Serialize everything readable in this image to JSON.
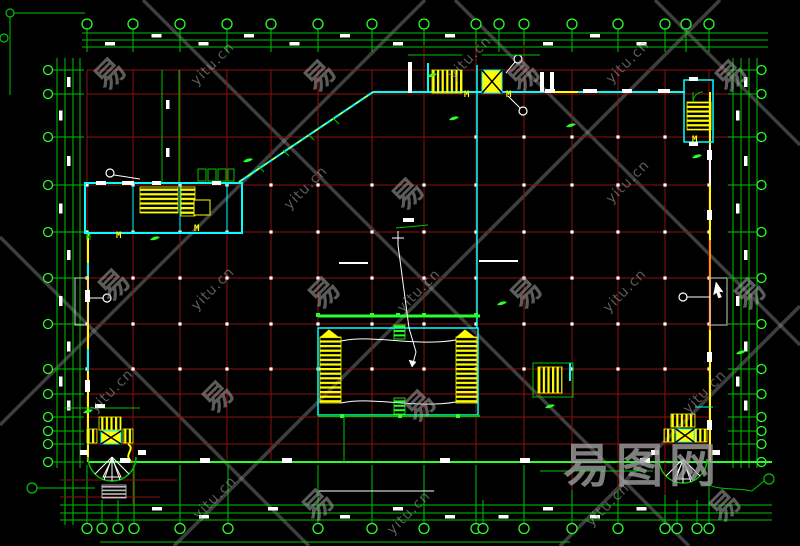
{
  "window": {
    "width": 800,
    "height": 546,
    "background": "#000000",
    "description": "CAD architectural floor plan drawing with column grid, dimension chains, stairs, elevators and corner stair towers"
  },
  "colors": {
    "r": "#8f0f0f",
    "R": "#d40000",
    "g": "#00c400",
    "G": "#2bff2b",
    "c": "#00ffff",
    "y": "#ffff00",
    "w": "#ffffff",
    "o": "#ff9100",
    "d": "#cfcfcf",
    "k": "#000000",
    "wm_line": "#9b9b9b"
  },
  "axes": {
    "vertical_x": [
      87,
      133,
      180,
      227,
      271,
      318,
      372,
      424,
      476,
      524,
      572,
      618,
      665,
      709
    ],
    "horizontal_y": [
      70,
      94,
      137,
      185,
      232,
      278,
      324,
      369,
      394,
      417,
      444
    ],
    "top_bubbles_x": [
      87,
      133,
      180,
      227,
      271,
      318,
      372,
      424,
      476,
      499,
      524,
      572,
      618,
      665,
      686,
      709
    ],
    "bottom_bubbles_x": [
      87,
      102,
      118,
      134,
      180,
      228,
      318,
      372,
      424,
      476,
      483,
      524,
      572,
      618,
      665,
      677,
      697,
      709
    ],
    "left_bubbles_y": [
      70,
      94,
      137,
      185,
      232,
      278,
      324,
      369,
      394,
      417,
      431,
      444,
      462
    ],
    "right_bubbles_y": [
      70,
      94,
      137,
      185,
      232,
      278,
      324,
      369,
      394,
      417,
      431,
      444,
      462
    ],
    "top_band_y": [
      33,
      40,
      47
    ],
    "bottom_band_y": [
      505,
      513,
      520
    ],
    "left_band_x": [
      57,
      65,
      73,
      80
    ],
    "right_band_x": [
      733,
      741,
      749,
      757
    ],
    "top_bubble_row_y": 24,
    "bottom_bubble_row_y": 528.5,
    "left_bubble_col_x": 48,
    "right_bubble_col_x": 761.5
  },
  "grid": {
    "node_rows": [
      185,
      232,
      278,
      324,
      369
    ],
    "node_row_partial": {
      "y": 137,
      "x": [
        476,
        524,
        572,
        618,
        665
      ]
    },
    "green_bottom_line_y": 462
  },
  "features": [
    [
      "ln",
      88,
      232,
      88,
      462,
      "y",
      2
    ],
    [
      "ln",
      88,
      263,
      88,
      276,
      "c",
      2
    ],
    [
      "ln",
      88,
      349,
      88,
      371,
      "c",
      2
    ],
    [
      "ln",
      88,
      428,
      88,
      445,
      "c",
      2
    ],
    [
      "ln",
      710,
      92,
      710,
      462,
      "y",
      2
    ],
    [
      "ln",
      710,
      145,
      710,
      185,
      "w",
      2
    ],
    [
      "ln",
      710,
      240,
      710,
      330,
      "o",
      2
    ],
    [
      "ln",
      373,
      92,
      685,
      92,
      "c",
      2
    ],
    [
      "ln",
      239,
      182,
      373,
      92,
      "c",
      2
    ],
    [
      "ln",
      239,
      182,
      373,
      92,
      "y",
      1,
      "5 5"
    ],
    [
      "ln",
      88,
      462,
      772,
      462,
      "G",
      2
    ],
    [
      "ln",
      319,
      491,
      434,
      491,
      "w",
      1
    ],
    [
      "ln",
      100,
      542,
      570,
      542,
      "g",
      1
    ],
    [
      "ln",
      258,
      166,
      264,
      172,
      "g",
      1
    ],
    [
      "ln",
      283,
      150,
      289,
      156,
      "g",
      1
    ],
    [
      "ln",
      308,
      134,
      314,
      140,
      "g",
      1
    ],
    [
      "ln",
      333,
      118,
      339,
      124,
      "g",
      1
    ],
    [
      "ln",
      424,
      45,
      424,
      70,
      "r",
      1
    ],
    [
      "ln",
      476,
      45,
      476,
      70,
      "r",
      1
    ],
    [
      "ln",
      524,
      45,
      524,
      70,
      "r",
      1
    ],
    [
      "ln",
      133,
      462,
      133,
      505,
      "r",
      1
    ],
    [
      "ln",
      572,
      462,
      572,
      490,
      "r",
      1
    ],
    [
      "ln",
      618,
      462,
      618,
      490,
      "r",
      1
    ],
    [
      "ln",
      665,
      462,
      665,
      495,
      "r",
      1
    ],
    [
      "ln",
      60,
      480,
      177,
      480,
      "r",
      1
    ],
    [
      "ln",
      60,
      497,
      160,
      497,
      "r",
      1
    ],
    [
      "ln",
      540,
      471,
      653,
      471,
      "g",
      1
    ],
    [
      "rc",
      85,
      183,
      157,
      50,
      "c",
      null,
      2
    ],
    [
      "ln",
      133,
      183,
      133,
      233,
      "c",
      1
    ],
    [
      "ln",
      180,
      183,
      180,
      233,
      "c",
      1
    ],
    [
      "ln",
      227,
      183,
      227,
      233,
      "c",
      1
    ],
    [
      "hh",
      140,
      187,
      38,
      26
    ],
    [
      "hh",
      181,
      187,
      14,
      29
    ],
    [
      "rc",
      194,
      200,
      16,
      15,
      "y",
      "k",
      1
    ],
    [
      "rc",
      198,
      169,
      8,
      12,
      "g",
      null,
      1
    ],
    [
      "rc",
      208,
      169,
      8,
      12,
      "g",
      null,
      1
    ],
    [
      "rc",
      218,
      169,
      8,
      12,
      "g",
      null,
      1
    ],
    [
      "rc",
      228,
      169,
      6,
      12,
      "g",
      null,
      1
    ],
    [
      "tx",
      116,
      238,
      "M",
      "y",
      9
    ],
    [
      "tx",
      194,
      231,
      "M",
      "y",
      9
    ],
    [
      "tx",
      86,
      240,
      "M",
      "g",
      8
    ],
    [
      "rc",
      96,
      181,
      10,
      4,
      null,
      "w",
      0
    ],
    [
      "rc",
      122,
      181,
      12,
      4,
      null,
      "w",
      0
    ],
    [
      "rc",
      152,
      181,
      9,
      4,
      null,
      "w",
      0
    ],
    [
      "rc",
      212,
      181,
      9,
      4,
      null,
      "w",
      0
    ],
    [
      "ci",
      110,
      173,
      4,
      "w"
    ],
    [
      "ln",
      114,
      175,
      140,
      179,
      "w",
      1
    ],
    [
      "ln",
      162,
      70,
      162,
      182,
      "g",
      1
    ],
    [
      "ln",
      179,
      70,
      179,
      182,
      "g",
      1
    ],
    [
      "rc",
      166,
      100,
      3.5,
      9,
      null,
      "w",
      0
    ],
    [
      "rc",
      166,
      148,
      3.5,
      9,
      null,
      "w",
      0
    ],
    [
      "rc",
      75,
      278,
      13,
      47,
      "d",
      null,
      1
    ],
    [
      "ci",
      107,
      298,
      4,
      "w"
    ],
    [
      "ln",
      88,
      298,
      103,
      298,
      "w",
      1
    ],
    [
      "rc",
      710,
      278,
      17,
      47,
      "d",
      null,
      1
    ],
    [
      "ci",
      683,
      297,
      4,
      "w"
    ],
    [
      "ln",
      687,
      297,
      710,
      297,
      "w",
      1
    ],
    [
      "pa",
      "M716 282 L723 292 L719 291.5 L721.5 297 L718.5 298 L716.5 292.5 L713.5 295 Z",
      "w",
      0.5,
      "w"
    ],
    [
      "rc",
      408,
      62,
      4,
      31,
      null,
      "w",
      0
    ],
    [
      "ln",
      428,
      63,
      428,
      93,
      "c",
      2
    ],
    [
      "hv",
      432,
      70,
      30,
      23
    ],
    [
      "xb",
      482,
      70,
      20,
      23
    ],
    [
      "tx",
      464,
      97,
      "M",
      "y",
      9
    ],
    [
      "tx",
      506,
      97,
      "M",
      "y",
      9
    ],
    [
      "ci",
      518,
      59,
      4,
      "w"
    ],
    [
      "ln",
      506,
      73,
      515,
      62,
      "w",
      1
    ],
    [
      "ci",
      523,
      111,
      4,
      "w"
    ],
    [
      "ln",
      508,
      96,
      520,
      108,
      "w",
      1
    ],
    [
      "ln",
      547,
      92,
      578,
      92,
      "y",
      2
    ],
    [
      "rc",
      540,
      72,
      4,
      20,
      null,
      "w",
      0
    ],
    [
      "rc",
      550,
      72,
      4,
      20,
      null,
      "w",
      0
    ],
    [
      "rc",
      545,
      89,
      10,
      4,
      null,
      "w",
      0
    ],
    [
      "rc",
      583,
      89,
      14,
      4,
      null,
      "w",
      0
    ],
    [
      "rc",
      622,
      89,
      10,
      4,
      null,
      "w",
      0
    ],
    [
      "rc",
      658,
      89,
      12,
      4,
      null,
      "w",
      0
    ],
    [
      "ln",
      477,
      65,
      477,
      328,
      "c",
      1.5
    ],
    [
      "ln",
      408,
      55,
      462,
      55,
      "g",
      1
    ],
    [
      "ln",
      482,
      55,
      540,
      55,
      "g",
      1
    ],
    [
      "rc",
      684,
      80,
      29,
      62,
      "c",
      null,
      1.5
    ],
    [
      "hh",
      687,
      102,
      24,
      28
    ],
    [
      "pa",
      "M693 102 A10 10 0 0 1 703 92",
      "g",
      1,
      null
    ],
    [
      "ln",
      693,
      102,
      693,
      92,
      "g",
      1
    ],
    [
      "tx",
      692,
      142,
      "M",
      "y",
      9
    ],
    [
      "rc",
      689,
      77,
      9,
      4,
      null,
      "w",
      0
    ],
    [
      "rc",
      689,
      142,
      9,
      4,
      null,
      "w",
      0
    ],
    [
      "rc",
      707,
      150,
      5,
      10,
      null,
      "w",
      0
    ],
    [
      "rc",
      707,
      210,
      5,
      10,
      null,
      "w",
      0
    ],
    [
      "rc",
      707,
      352,
      5,
      10,
      null,
      "w",
      0
    ],
    [
      "rc",
      707,
      420,
      5,
      10,
      null,
      "w",
      0
    ],
    [
      "ln",
      318,
      316,
      480,
      316,
      "G",
      3
    ],
    [
      "rc",
      316,
      313,
      4,
      4,
      null,
      "G",
      0
    ],
    [
      "rc",
      370,
      313,
      4,
      4,
      null,
      "G",
      0
    ],
    [
      "rc",
      396,
      313,
      4,
      4,
      null,
      "G",
      0
    ],
    [
      "rc",
      422,
      313,
      4,
      4,
      null,
      "G",
      0
    ],
    [
      "rc",
      474,
      313,
      4,
      4,
      null,
      "G",
      0
    ],
    [
      "rc",
      318,
      328,
      160,
      87,
      "c",
      null,
      1.5
    ],
    [
      "hh",
      320,
      337,
      21,
      66
    ],
    [
      "pa",
      "M321 337 L329 330 L338 337 Z",
      "y",
      1,
      "y"
    ],
    [
      "hh",
      456,
      337,
      21,
      66
    ],
    [
      "pa",
      "M457 337 L465 330 L474 337 Z",
      "y",
      1,
      "y"
    ],
    [
      "pa",
      "M341 341 C 372 334 414 347 456 340",
      "w",
      1,
      null
    ],
    [
      "pa",
      "M341 403 C 372 396 414 409 456 402",
      "w",
      1,
      null
    ],
    [
      "hg",
      394,
      325,
      11,
      14
    ],
    [
      "hg",
      394,
      398,
      11,
      18
    ],
    [
      "ln",
      318,
      416,
      480,
      416,
      "g",
      2
    ],
    [
      "rc",
      340,
      414,
      4,
      4,
      null,
      "G",
      0
    ],
    [
      "rc",
      398,
      414,
      4,
      4,
      null,
      "G",
      0
    ],
    [
      "rc",
      456,
      414,
      4,
      4,
      null,
      "G",
      0
    ],
    [
      "ln",
      344,
      417,
      344,
      462,
      "g",
      1
    ],
    [
      "ln",
      392,
      238,
      404,
      238,
      "w",
      1
    ],
    [
      "ln",
      398,
      231,
      398,
      245,
      "w",
      1
    ],
    [
      "pa",
      "M398 245 L409 328 L416 352 L412 367",
      "w",
      1,
      null
    ],
    [
      "pa",
      "M412 367 L409 360 L416 362 Z",
      "w",
      0.5,
      "w"
    ],
    [
      "ln",
      396,
      228,
      428,
      225,
      "g",
      1
    ],
    [
      "rc",
      403,
      218,
      11,
      4,
      null,
      "w",
      0
    ],
    [
      "ln",
      339,
      263,
      368,
      263,
      "w",
      2
    ],
    [
      "ln",
      479,
      261,
      518,
      261,
      "w",
      2
    ],
    [
      "rc",
      533,
      363,
      40,
      34,
      "g",
      null,
      1
    ],
    [
      "hv",
      538,
      367,
      24,
      26
    ],
    [
      "ln",
      570,
      363,
      570,
      381,
      "c",
      2
    ],
    [
      "ln",
      65,
      408,
      140,
      408,
      "g",
      1
    ],
    [
      "rc",
      95,
      404,
      10,
      4,
      null,
      "w",
      0
    ],
    [
      "hv",
      99,
      417,
      22,
      13
    ],
    [
      "xb",
      101,
      431,
      20,
      13
    ],
    [
      "hv",
      87,
      429,
      10,
      14
    ],
    [
      "hv",
      123,
      429,
      10,
      14
    ],
    [
      "pa",
      "M128 444 C 136 449 123 455 131 461",
      "y",
      2,
      null
    ],
    [
      "pa",
      "M88 457 A24 24 0 0 0 136 457",
      "g",
      1.5,
      null
    ],
    [
      "ln",
      112,
      457,
      95,
      474,
      "w",
      1
    ],
    [
      "ln",
      112,
      457,
      104,
      480,
      "w",
      1
    ],
    [
      "ln",
      112,
      457,
      112,
      481,
      "w",
      1
    ],
    [
      "ln",
      112,
      457,
      120,
      480,
      "w",
      1
    ],
    [
      "ln",
      112,
      457,
      129,
      474,
      "w",
      1
    ],
    [
      "pa",
      "M112 459 L103 477 L121 477 Z",
      "w",
      1,
      null
    ],
    [
      "gr",
      102,
      485,
      24,
      13
    ],
    [
      "rc",
      80,
      450,
      8,
      5,
      null,
      "w",
      0
    ],
    [
      "rc",
      138,
      450,
      8,
      5,
      null,
      "w",
      0
    ],
    [
      "hv",
      671,
      414,
      24,
      13
    ],
    [
      "xb",
      676,
      429,
      18,
      13
    ],
    [
      "hv",
      664,
      429,
      10,
      13
    ],
    [
      "hv",
      695,
      429,
      12,
      13
    ],
    [
      "pa",
      "M659 459 A24 24 0 0 0 707 459",
      "g",
      1.5,
      null
    ],
    [
      "ln",
      683,
      459,
      666,
      476,
      "w",
      1
    ],
    [
      "ln",
      683,
      459,
      675,
      482,
      "w",
      1
    ],
    [
      "ln",
      683,
      459,
      683,
      483,
      "w",
      1
    ],
    [
      "ln",
      683,
      459,
      691,
      482,
      "w",
      1
    ],
    [
      "ln",
      683,
      459,
      700,
      476,
      "w",
      1
    ],
    [
      "pa",
      "M683 461 L674 479 L692 479 Z",
      "w",
      1,
      null
    ],
    [
      "pa",
      "M700 481 C 718 492 736 487 752 491",
      "g",
      1,
      null
    ],
    [
      "rc",
      651,
      450,
      8,
      5,
      null,
      "w",
      0
    ],
    [
      "rc",
      712,
      450,
      8,
      5,
      null,
      "w",
      0
    ],
    [
      "ln",
      695,
      407,
      713,
      407,
      "c",
      1
    ],
    [
      "ci",
      32,
      488,
      5,
      "g"
    ],
    [
      "ln",
      37,
      488,
      95,
      488,
      "g",
      1
    ],
    [
      "ci",
      769,
      479,
      5,
      "g"
    ],
    [
      "ln",
      752,
      491,
      764,
      481,
      "g",
      1
    ],
    [
      "ci",
      10,
      13,
      4,
      "g"
    ],
    [
      "ln",
      14,
      13,
      85,
      13,
      "g",
      1
    ],
    [
      "ci",
      4,
      38,
      4,
      "g"
    ],
    [
      "ln",
      10,
      17,
      10,
      95,
      "g",
      1
    ],
    [
      "rc",
      120,
      458,
      10,
      5,
      null,
      "w",
      0
    ],
    [
      "rc",
      200,
      458,
      10,
      5,
      null,
      "w",
      0
    ],
    [
      "rc",
      282,
      458,
      10,
      5,
      null,
      "w",
      0
    ],
    [
      "rc",
      440,
      458,
      10,
      5,
      null,
      "w",
      0
    ],
    [
      "rc",
      520,
      458,
      10,
      5,
      null,
      "w",
      0
    ],
    [
      "rc",
      640,
      458,
      10,
      5,
      null,
      "w",
      0
    ],
    [
      "rc",
      85,
      290,
      5,
      12,
      null,
      "w",
      0
    ],
    [
      "rc",
      85,
      380,
      5,
      12,
      null,
      "w",
      0
    ],
    [
      "sq",
      243,
      162
    ],
    [
      "sq",
      427,
      77
    ],
    [
      "sq",
      449,
      120
    ],
    [
      "sq",
      497,
      305
    ],
    [
      "sq",
      150,
      240
    ],
    [
      "sq",
      545,
      408
    ],
    [
      "sq",
      692,
      158
    ],
    [
      "sq",
      736,
      354
    ],
    [
      "sq",
      566,
      127
    ],
    [
      "sq",
      83,
      413
    ]
  ],
  "watermarks": {
    "brand": "易图网",
    "brand_pos": [
      563,
      443
    ],
    "tile_char": "易",
    "tile_domain": "yitu.cn",
    "tiles": [
      {
        "t": "c",
        "x": 108,
        "y": 72
      },
      {
        "t": "u",
        "x": 213,
        "y": 64
      },
      {
        "t": "c",
        "x": 318,
        "y": 74
      },
      {
        "t": "u",
        "x": 470,
        "y": 58
      },
      {
        "t": "c",
        "x": 522,
        "y": 74
      },
      {
        "t": "u",
        "x": 628,
        "y": 62
      },
      {
        "t": "c",
        "x": 729,
        "y": 74
      },
      {
        "t": "u",
        "x": 306,
        "y": 188
      },
      {
        "t": "c",
        "x": 406,
        "y": 192
      },
      {
        "t": "u",
        "x": 628,
        "y": 182
      },
      {
        "t": "c",
        "x": 112,
        "y": 283
      },
      {
        "t": "u",
        "x": 213,
        "y": 289
      },
      {
        "t": "c",
        "x": 322,
        "y": 291
      },
      {
        "t": "u",
        "x": 419,
        "y": 291
      },
      {
        "t": "c",
        "x": 524,
        "y": 291
      },
      {
        "t": "u",
        "x": 625,
        "y": 291
      },
      {
        "t": "c",
        "x": 748,
        "y": 292
      },
      {
        "t": "u",
        "x": 112,
        "y": 391
      },
      {
        "t": "c",
        "x": 216,
        "y": 395
      },
      {
        "t": "c",
        "x": 418,
        "y": 404
      },
      {
        "t": "u",
        "x": 705,
        "y": 392
      },
      {
        "t": "u",
        "x": 215,
        "y": 498
      },
      {
        "t": "c",
        "x": 316,
        "y": 503
      },
      {
        "t": "u",
        "x": 409,
        "y": 513
      },
      {
        "t": "u",
        "x": 608,
        "y": 505
      },
      {
        "t": "c",
        "x": 723,
        "y": 504
      }
    ],
    "diagonals": [
      [
        143,
        0,
        689,
        546
      ],
      [
        0,
        237,
        309,
        546
      ],
      [
        455,
        0,
        800,
        345
      ],
      [
        655,
        0,
        800,
        145
      ],
      [
        0,
        425,
        425,
        0
      ],
      [
        174,
        546,
        720,
        0
      ],
      [
        560,
        546,
        800,
        306
      ]
    ]
  }
}
